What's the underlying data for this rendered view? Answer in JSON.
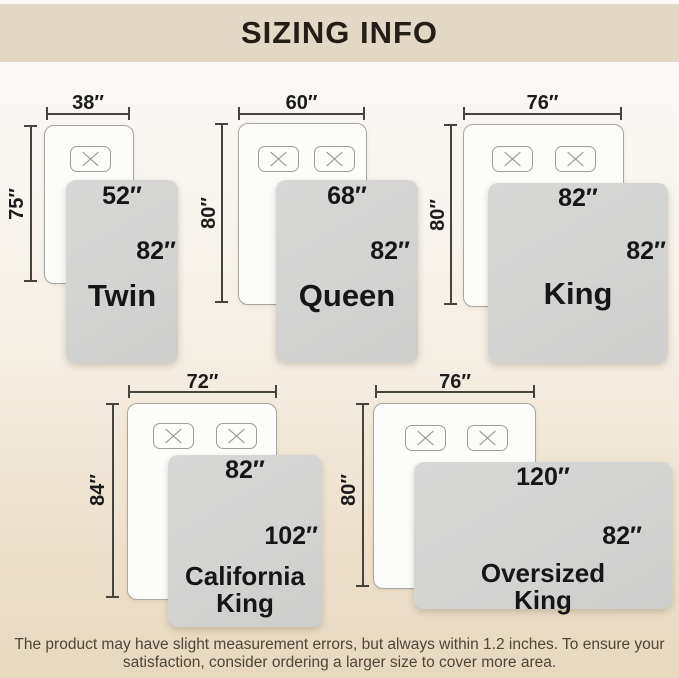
{
  "header": {
    "title": "SIZING INFO"
  },
  "diagrams": [
    {
      "name": "Twin",
      "bed_width": "38″",
      "bed_length": "75″",
      "blanket_width": "52″",
      "blanket_length": "82″"
    },
    {
      "name": "Queen",
      "bed_width": "60″",
      "bed_length": "80″",
      "blanket_width": "68″",
      "blanket_length": "82″"
    },
    {
      "name": "King",
      "bed_width": "76″",
      "bed_length": "80″",
      "blanket_width": "82″",
      "blanket_length": "82″"
    },
    {
      "name": "California\nKing",
      "bed_width": "72″",
      "bed_length": "84″",
      "blanket_width": "82″",
      "blanket_length": "102″"
    },
    {
      "name": "Oversized\nKing",
      "bed_width": "76″",
      "bed_length": "80″",
      "blanket_width": "120″",
      "blanket_length": "82″"
    }
  ],
  "footer": {
    "line1": "The product may have slight measurement errors, but always within 1.2 inches. To ensure your",
    "line2": "satisfaction, consider ordering a larger size to cover more area."
  },
  "colors": {
    "header_band": "#e3d8c6",
    "background_top": "#fbf9f8",
    "background_bottom": "#e7d8be",
    "blanket_gray": "#d3d3d2",
    "bed_white": "#fcfcfa",
    "text_dark": "#1c1c1c",
    "footer_text": "#4e4639"
  }
}
